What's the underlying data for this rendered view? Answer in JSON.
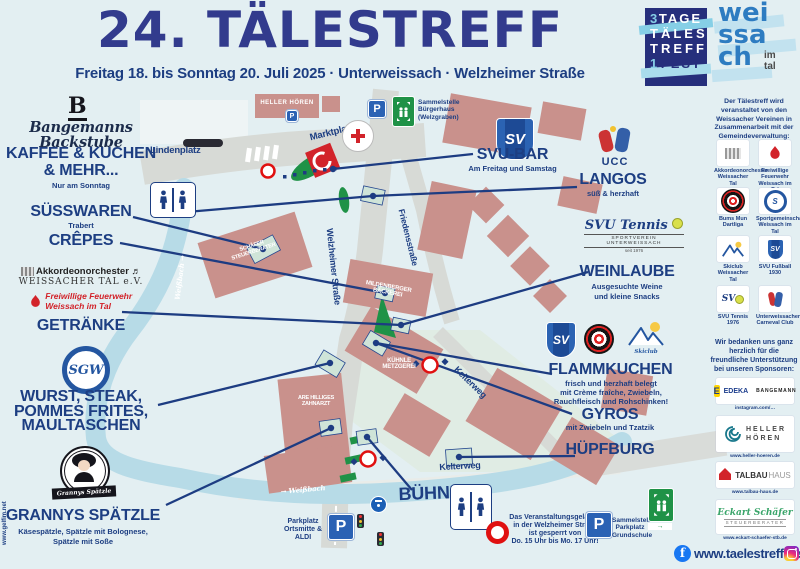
{
  "header": {
    "title": "24. TÄLESTREFF",
    "subtitle": "Freitag 18. bis Sonntag 20. Juli 2025 · Unterweissach · Welzheimer Straße"
  },
  "brand": {
    "fest": {
      "l1a": "3",
      "l1b": "TAGE",
      "l2": "TÄLES",
      "l3": "TREFF",
      "l4a": "1",
      "l4b": "FEST"
    },
    "town": {
      "t1": "wei",
      "t2": "ssa",
      "t3": "ch",
      "im": "im",
      "tal": "tal"
    }
  },
  "left": {
    "bakery": {
      "logo": "B",
      "brand": "Bangemanns Backstube",
      "title1": "KAFFEE & KUCHEN",
      "title2": "& MEHR...",
      "note": "Nur am Sonntag"
    },
    "suesswaren": {
      "title": "SÜSSWAREN",
      "note": "Trabert"
    },
    "crepes": {
      "title": "CRÊPES"
    },
    "akkordeon": {
      "line1": "Akkordeonorchester",
      "line2": "WEISSACHER TAL e.V."
    },
    "feuerwehr": {
      "line1": "Freiwillige Feuerwehr",
      "line2": "Weissach im Tal"
    },
    "getraenke": {
      "title": "GETRÄNKE"
    },
    "sgw": {
      "initials": "SGW"
    },
    "wurst": {
      "l1": "WURST, STEAK,",
      "l2": "POMMES FRITES,",
      "l3": "MAULTASCHEN"
    },
    "grannys": {
      "banner": "Grannys Spätzle",
      "title": "GRANNYS SPÄTZLE",
      "n1": "Käsespätzle, Spätzle mit Bolognese,",
      "n2": "Spätzle mit Soße"
    },
    "edge_url": "www.gelfim.net"
  },
  "right": {
    "svubar": {
      "logo": "SV",
      "title": "SVU-BAR",
      "note": "Am Freitag und Samstag"
    },
    "langos": {
      "logo": "UCC",
      "title": "LANGOS",
      "note": "süß & herzhaft"
    },
    "weinlaube": {
      "logo_script": "SVU Tennis",
      "logo_sub": "SPORTVEREIN UNTERWEISSACH",
      "logo_year": "seit 1976",
      "title": "WEINLAUBE",
      "n1": "Ausgesuchte Weine",
      "n2": "und kleine Snacks"
    },
    "flammkuchen": {
      "logo1": "SV",
      "logo3": "Skiclub",
      "title": "FLAMMKUCHEN",
      "n1": "frisch und herzhaft belegt",
      "n2": "mit Crème fraîche, Zwiebeln,",
      "n3": "Rauchfleisch und Rohschinken!"
    },
    "gyros": {
      "title": "GYROS",
      "note": "mit Zwiebeln und Tzatzik"
    },
    "huepfburg": {
      "title": "HÜPFBURG"
    },
    "buehne": {
      "title": "BÜHNE"
    }
  },
  "map": {
    "streets": {
      "lindenplatz": "Lindenplatz",
      "marktplatz": "Marktplatz",
      "friedensstrasse": "Friedensstraße",
      "welzheimer": "Welzheimer Straße",
      "kelterweg1": "Kelterweg",
      "kelterweg2": "Kelterweg",
      "weissbach1": "Weißbach →",
      "weissbach2": "→ Weißbach"
    },
    "buildings": {
      "heller": "HELLER HÖREN",
      "schaefer1": "SCHÄFER",
      "schaefer2": "STEUERBERATER",
      "milden1": "MILDENBERGER",
      "milden2": "BÄCKEREI",
      "kuehnle1": "KÜHNLE",
      "kuehnle2": "METZGEREI",
      "zahnarzt1": "ARE HILLIGES",
      "zahnarzt2": "ZAHNARZT"
    },
    "drk": "DEUTSCHES ROTES KREUZ",
    "p": "P",
    "sammel_top": {
      "l1": "Sammelstelle",
      "l2": "Bürgerhaus",
      "l3": "(Welzgraben)"
    },
    "sammel_bottom": {
      "l1": "Sammelstelle",
      "l2": "Parkplatz",
      "l3": "Grundschule"
    },
    "park_aldi": {
      "l1": "Parkplatz",
      "l2": "Ortsmitte &",
      "l3": "ALDI"
    },
    "notice": {
      "l1": "Das Veranstaltungsgelände",
      "l2": "in der Welzheimer Straße",
      "l3": "ist gesperrt von",
      "l4": "Do. 15 Uhr bis Mo. 17 Uhr!"
    }
  },
  "sidebar": {
    "intro": "Der Tälestreff wird veranstaltet von den Weissacher Vereinen in Zusammenarbeit mit der Gemeindeverwaltung:",
    "clubs": [
      {
        "name": "Akkordeonorchester Weissacher Tal"
      },
      {
        "name": "Freiwillige Feuerwehr Weissach im Tal"
      },
      {
        "name": "Bums Mun Dartliga"
      },
      {
        "name": "Sportgemeinschaft Weissach im Tal"
      },
      {
        "name": "Skiclub Weissacher Tal"
      },
      {
        "name": "SVU Fußball 1930"
      },
      {
        "name": "SVU Tennis 1976"
      },
      {
        "name": "Unterweissacher Carneval Club"
      }
    ],
    "thanks": "Wir bedanken uns ganz herzlich für die freundliche Unterstützung bei unseren Sponsoren:",
    "sponsors": {
      "edeka": {
        "name": "EDEKA",
        "partner": "BANGEMANN",
        "caption": "instagram.com/…"
      },
      "heller": {
        "name1": "HELLER",
        "name2": "HÖREN",
        "caption": "www.heller-hoeren.de"
      },
      "talbau": {
        "name1": "TALBAU",
        "name2": "HAUS",
        "caption": "www.talbau-haus.de"
      },
      "eckart": {
        "script": "Eckart Schäfer",
        "sub": "STEUERBERATER",
        "caption": "www.eckart-schaefer-stb.de"
      }
    }
  },
  "footer": {
    "website": "www.taelestreff.de"
  }
}
